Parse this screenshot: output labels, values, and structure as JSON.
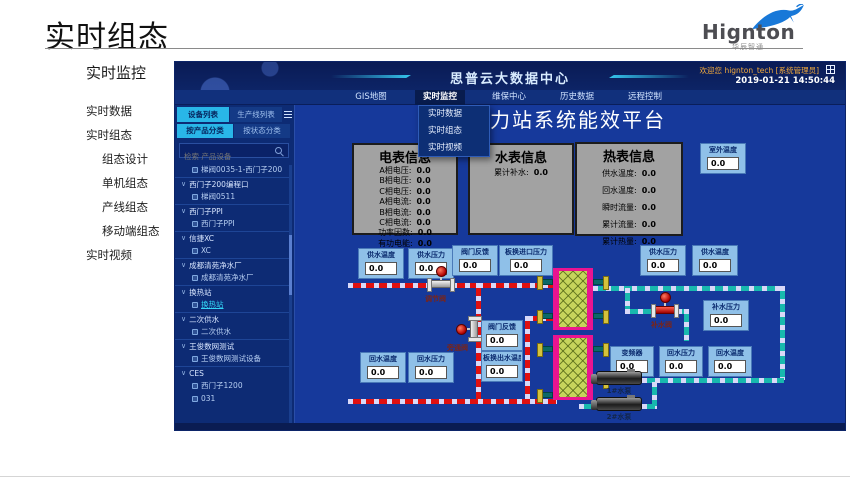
{
  "page": {
    "title": "实时组态",
    "logo": {
      "name": "Hignton",
      "subtitle": "华辰智通"
    }
  },
  "sidebar": {
    "header": "实时监控",
    "items": [
      {
        "label": "实时数据",
        "level": 0
      },
      {
        "label": "实时组态",
        "level": 0
      },
      {
        "label": "组态设计",
        "level": 1
      },
      {
        "label": "单机组态",
        "level": 1
      },
      {
        "label": "产线组态",
        "level": 1
      },
      {
        "label": "移动端组态",
        "level": 1
      },
      {
        "label": "实时视频",
        "level": 0
      }
    ]
  },
  "icons": {
    "chevron_down": "∨"
  },
  "shot": {
    "header": {
      "title": "思普云大数据中心",
      "welcome": "欢迎您",
      "user": "hignton_tech [系统管理员]",
      "datetime": "2019-01-21 14:50:44"
    },
    "nav": {
      "tabs": [
        "GIS地图",
        "实时监控",
        "维保中心",
        "历史数据",
        "远程控制"
      ],
      "active": "实时监控"
    },
    "dropdown": {
      "items": [
        "实时数据",
        "实时组态",
        "实时视频"
      ]
    },
    "device_panel": {
      "tabs": [
        "设备列表",
        "生产线列表"
      ],
      "subtabs": [
        "按产品分类",
        "按状态分类"
      ],
      "search_placeholder": "检索 产品设备",
      "tree": [
        {
          "label": "梯阀0035-1-西门子200",
          "type": "leaf"
        },
        {
          "label": "西门子200编程口",
          "type": "group"
        },
        {
          "label": "梯阀0511",
          "type": "leaf"
        },
        {
          "label": "西门子PPI",
          "type": "group"
        },
        {
          "label": "西门子PPI",
          "type": "leaf"
        },
        {
          "label": "信捷XC",
          "type": "group"
        },
        {
          "label": "XC",
          "type": "leaf"
        },
        {
          "label": "成都清苑净水厂",
          "type": "group"
        },
        {
          "label": "成都清苑净水厂",
          "type": "leaf"
        },
        {
          "label": "换热站",
          "type": "group"
        },
        {
          "label": "换热站",
          "type": "leaf",
          "selected": true
        },
        {
          "label": "二次供水",
          "type": "group"
        },
        {
          "label": "二次供水",
          "type": "leaf"
        },
        {
          "label": "王俊数网测试",
          "type": "group"
        },
        {
          "label": "王俊数网测试设备",
          "type": "leaf"
        },
        {
          "label": "CES",
          "type": "group"
        },
        {
          "label": "西门子1200",
          "type": "leaf"
        },
        {
          "label": "031",
          "type": "leaf"
        }
      ]
    },
    "main": {
      "title": "热力站系统能效平台",
      "panels": {
        "electric": {
          "title": "电表信息",
          "rows": [
            {
              "label": "A相电压:",
              "value": "0.0"
            },
            {
              "label": "B相电压:",
              "value": "0.0"
            },
            {
              "label": "C相电压:",
              "value": "0.0"
            },
            {
              "label": "A相电流:",
              "value": "0.0"
            },
            {
              "label": "B相电流:",
              "value": "0.0"
            },
            {
              "label": "C相电流:",
              "value": "0.0"
            },
            {
              "label": "功率因数:",
              "value": "0.0"
            },
            {
              "label": "有功电能:",
              "value": "0.0"
            }
          ]
        },
        "water": {
          "title": "水表信息",
          "rows": [
            {
              "label": "累计补水:",
              "value": "0.0"
            }
          ]
        },
        "heat": {
          "title": "热表信息",
          "rows": [
            {
              "label": "供水温度:",
              "value": "0.0"
            },
            {
              "label": "回水温度:",
              "value": "0.0"
            },
            {
              "label": "瞬时流量:",
              "value": "0.0"
            },
            {
              "label": "累计流量:",
              "value": "0.0"
            },
            {
              "label": "累计热量:",
              "value": "0.0"
            }
          ]
        }
      },
      "gauges": [
        {
          "label": "室外温度",
          "value": "0.0"
        },
        {
          "label": "供水温度",
          "value": "0.0"
        },
        {
          "label": "供水压力",
          "value": "0.0"
        },
        {
          "label": "阀门反馈",
          "value": "0.0"
        },
        {
          "label": "板换进口压力",
          "value": "0.0"
        },
        {
          "label": "供水压力",
          "value": "0.0"
        },
        {
          "label": "供水温度",
          "value": "0.0"
        },
        {
          "label": "补水压力",
          "value": "0.0"
        },
        {
          "label": "阀门反馈",
          "value": "0.0"
        },
        {
          "label": "板换出水温度",
          "value": "0.0"
        },
        {
          "label": "回水温度",
          "value": "0.0"
        },
        {
          "label": "回水压力",
          "value": "0.0"
        },
        {
          "label": "变频器",
          "value": "0.0"
        },
        {
          "label": "回水压力",
          "value": "0.0"
        },
        {
          "label": "回水温度",
          "value": "0.0"
        }
      ],
      "equipment": {
        "valves": [
          "调节阀",
          "旁通阀",
          "补水阀"
        ],
        "pumps": [
          "1#水泵",
          "2#水泵"
        ]
      }
    },
    "colors": {
      "accent_cyan": "#29b6e8",
      "pipe_red": "#e01010",
      "pipe_teal": "#18b8ae",
      "exchanger_magenta": "#ea1490",
      "exchanger_fill": "#c6d45c"
    }
  }
}
